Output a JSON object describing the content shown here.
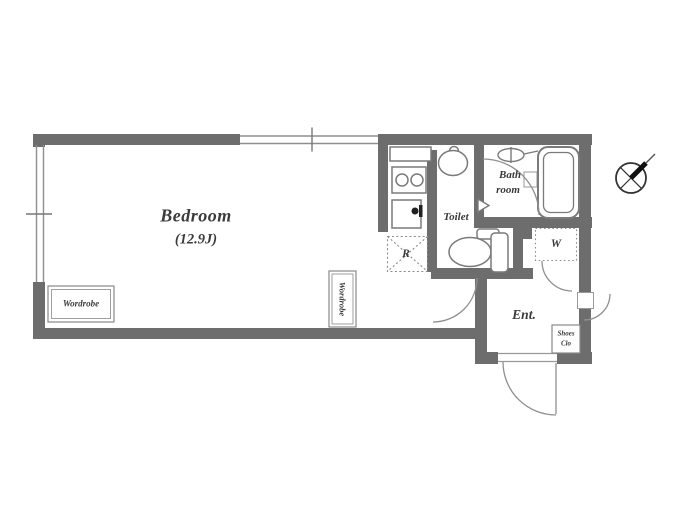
{
  "plan": {
    "bedroom": {
      "name": "Bedroom",
      "area": "(12.9J)"
    },
    "wardrobe_left": {
      "label": "Wordrobe"
    },
    "wardrobe_mid": {
      "label": "Wordrobe"
    },
    "toilet": {
      "label": "Toilet"
    },
    "bathroom": {
      "label_line1": "Bath",
      "label_line2": "room"
    },
    "refrigerator_space": {
      "label": "R"
    },
    "washer_space": {
      "label": "W"
    },
    "entrance": {
      "label": "Ent."
    },
    "shoe_closet": {
      "label_line1": "Shoes",
      "label_line2": "Clo"
    }
  },
  "colors": {
    "wall": "#6d6d6d",
    "thin_line": "#8f8f8f",
    "fixture_stroke": "#7a7a7a",
    "text": "#3b3b3b",
    "compass": "#1f1f1f"
  }
}
